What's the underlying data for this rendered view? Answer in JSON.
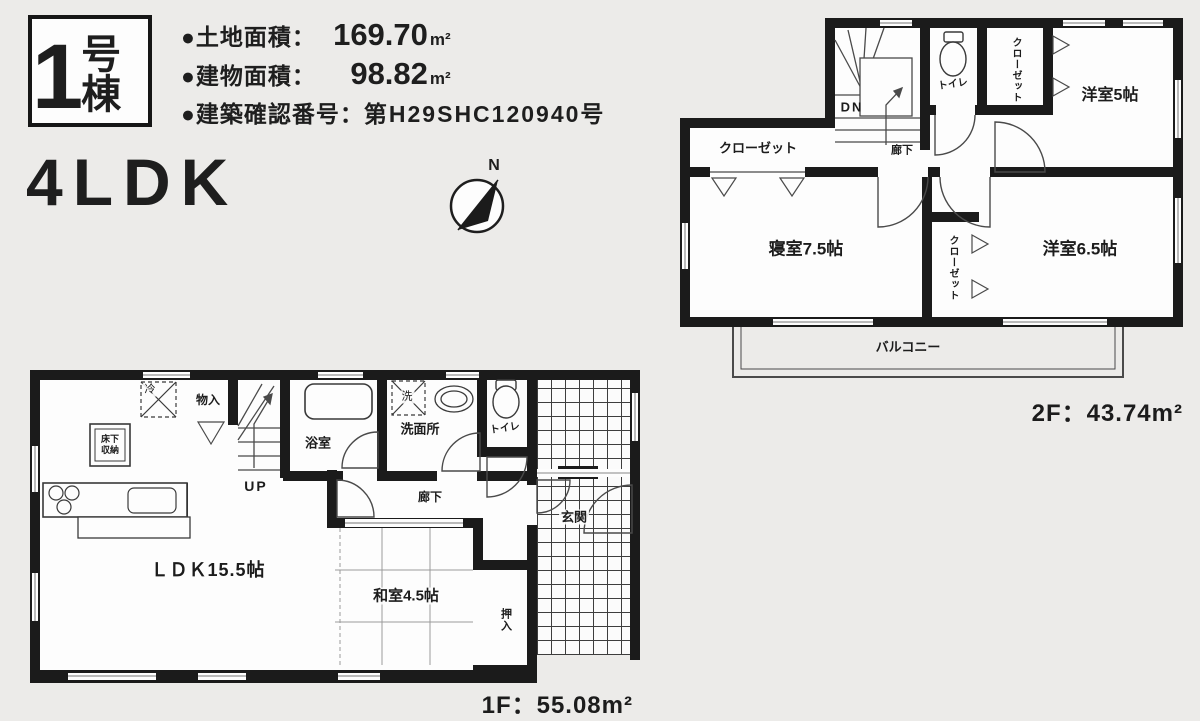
{
  "page": {
    "background": "#ecebe9"
  },
  "header": {
    "badge": {
      "number": "1",
      "suffix": "号棟"
    },
    "specs": [
      {
        "label": "●土地面積：",
        "value": "169.70",
        "unit": "m²"
      },
      {
        "label": "●建物面積：",
        "value": "98.82",
        "unit": "m²"
      },
      {
        "label": "●建築確認番号：",
        "value": "第H29SHC120940号",
        "unit": ""
      }
    ],
    "layout_type": "4LDK",
    "compass_n": "N"
  },
  "floor2": {
    "area_label": "2F：43.74m²",
    "rooms": {
      "western5": "洋室5帖",
      "closet_top": "クローゼット",
      "toilet": "トイレ",
      "stairs_dn": "DN",
      "hallway": "廊下",
      "closet_left": "クローゼット",
      "bedroom": "寝室7.5帖",
      "closet_mid": "クローゼット",
      "western65": "洋室6.5帖",
      "balcony": "バルコニー"
    }
  },
  "floor1": {
    "area_label": "1F：55.08m²",
    "rooms": {
      "ldk": "ＬＤＫ15.5帖",
      "washitsu": "和室4.5帖",
      "oshiire": "押入",
      "genkan": "玄関",
      "hallway": "廊下",
      "toilet": "トイレ",
      "washroom": "洗面所",
      "washer": "洗",
      "bath": "浴室",
      "storage": "物入",
      "fridge": "冷",
      "underfloor": "床下収納",
      "stairs_up": "UP"
    }
  }
}
